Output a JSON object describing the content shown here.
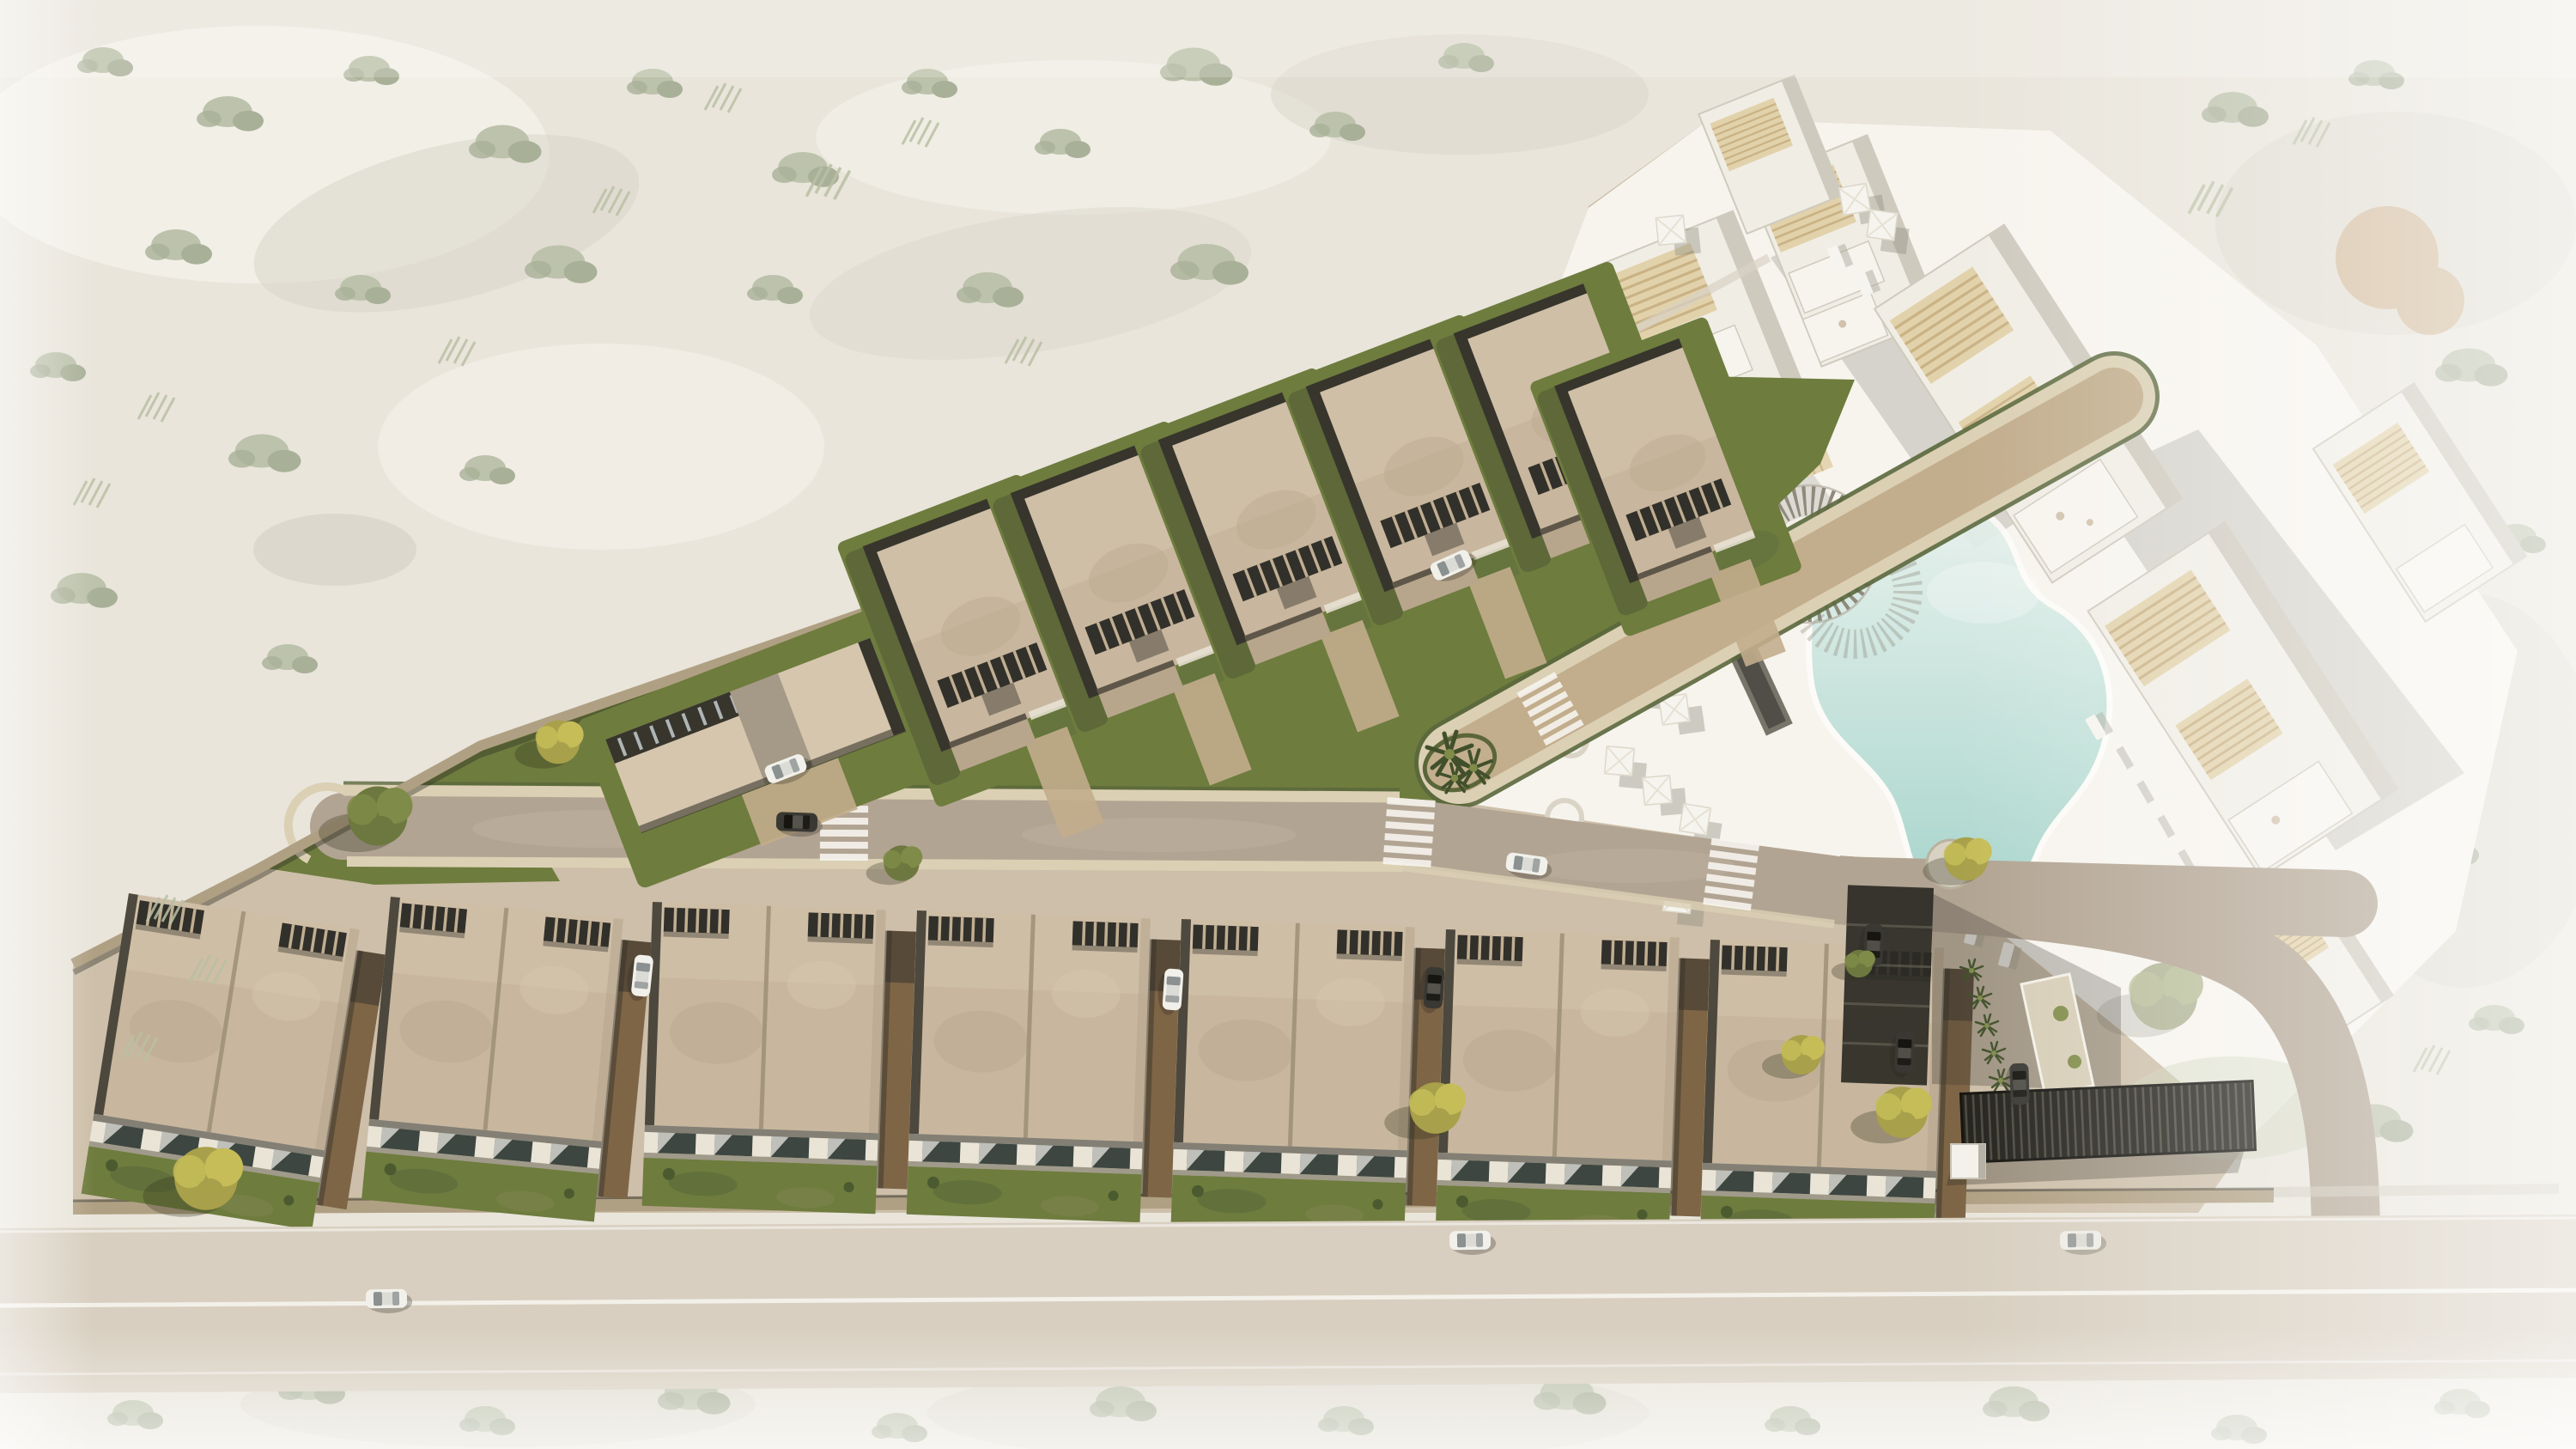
{
  "scene": {
    "type": "aerial-architectural-render",
    "view": "top-down drone view",
    "terrain": "desert scrub with faded white vignette around the development",
    "buildings": {
      "detached_villas": 6,
      "clubhouse": 1,
      "townhouse_blocks": 7,
      "resort_apartment_blocks": 7
    },
    "amenities": {
      "swimming_pool": 1,
      "round_pergola_bar": 1,
      "slat_canopies": 2,
      "parasols": 14,
      "sun_loungers": 12,
      "round_daybeds": 2,
      "carport_row": 1,
      "entry_pergola": 1
    },
    "vehicles": {
      "cars_visible": 13
    },
    "circulation": {
      "internal_road": 1,
      "cul_de_sac_drive": 1,
      "palm_island": 1,
      "public_road": 1,
      "crosswalks": 4
    }
  },
  "palette": {
    "desert_sand": "#e9e5db",
    "desert_sand_light": "#f4f1ea",
    "desert_patch": "#d9d5c9",
    "veg_faint": "#bcc2ab",
    "veg_faint_2": "#a9b098",
    "cactus_faint": "#b9bfa3",
    "rust_tree": "#c49a66",
    "plaza_white": "#f7f4ee",
    "plaza_shadow": "#75726a",
    "pool_edge": "#e9f2ee",
    "pool_deep": "#9ed2c8",
    "wood_slats": "#e2d2ab",
    "wood_slat_line": "#c9b285",
    "resort_wall": "#f0ede5",
    "resort_edge": "#cfcabe",
    "site_ground": "#cdbfa9",
    "road": "#b2a492",
    "road_light": "#c6b9a8",
    "paver": "#dbd0b4",
    "gravel": "#c2ad8c",
    "hedge": "#5a673c",
    "grass": "#6e7c3e",
    "grass_dark": "#55633a",
    "roof_tan": "#c8b79e",
    "roof_tan_light": "#d6c6ae",
    "roof_mottle": "#b7a68c",
    "louver_dark": "#32302a",
    "slat_divider": "#c0ae92",
    "shadow_dark": "#37352c",
    "brick_wall": "#b0a083",
    "facade_white": "#eae4d6",
    "glass_dark": "#3d4640",
    "car_white": "#f1f0ea",
    "car_dark": "#3a3833",
    "pergola_dark": "#26251f",
    "palm_green": "#41502b",
    "tree_olive": "#6d7840",
    "tree_olive_light": "#7f8b48",
    "tree_yellow": "#a8a04a",
    "tree_yellow_light": "#c6bc58",
    "island_gravel": "#c3ae8d",
    "road_bottom": "#d8cfc0",
    "line_white": "#f6f4ee"
  }
}
